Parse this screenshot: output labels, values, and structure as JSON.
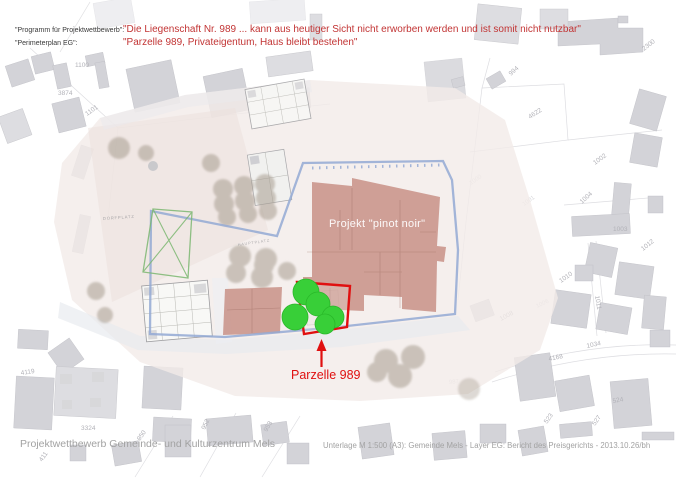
{
  "header": {
    "line1_label": "\"Programm für Projektwettbewerb\":",
    "line1_quote": "\"Die Liegenschaft Nr. 989 ... kann aus heutiger Sicht nicht erworben werden und ist somit nicht nutzbar\"",
    "line2_label": "\"Perimeterplan EG\":",
    "line2_quote": "\"Parzelle 989, Privateigentum, Haus bleibt bestehen\""
  },
  "plan": {
    "project_label": "Projekt \"pinot noir\"",
    "parcel_callout": "Parzelle 989",
    "plaza_labels": [
      "DORFPLATZ",
      "HAUPTPLATZ"
    ]
  },
  "map": {
    "parcel_numbers": [
      "1100",
      "3874",
      "1101",
      "2300",
      "994",
      "4622",
      "1002",
      "1004",
      "1003",
      "1000",
      "1001",
      "1012",
      "1010",
      "1011",
      "1034",
      "4168",
      "1008",
      "1006",
      "987",
      "4119",
      "3324",
      "411",
      "950",
      "952",
      "953",
      "523",
      "524",
      "527"
    ]
  },
  "footer": {
    "left": "Projektwettbewerb Gemeinde- und Kulturzentrum Mels",
    "right": "Unterlage M 1:500 (A3): Gemeinde Mels - Layer EG: Bericht des Preisgerichts - 2013.10.26/bh"
  },
  "colors": {
    "quote_red": "#c23434",
    "highlight_red": "#e01010",
    "perimeter_blue": "#93a9d4",
    "square_green": "#7cb871",
    "tree_green": "#38cf38",
    "building_salmon": "#c4887e",
    "map_gray": "#d3d3d8",
    "footer_gray": "#a2a2a2"
  }
}
